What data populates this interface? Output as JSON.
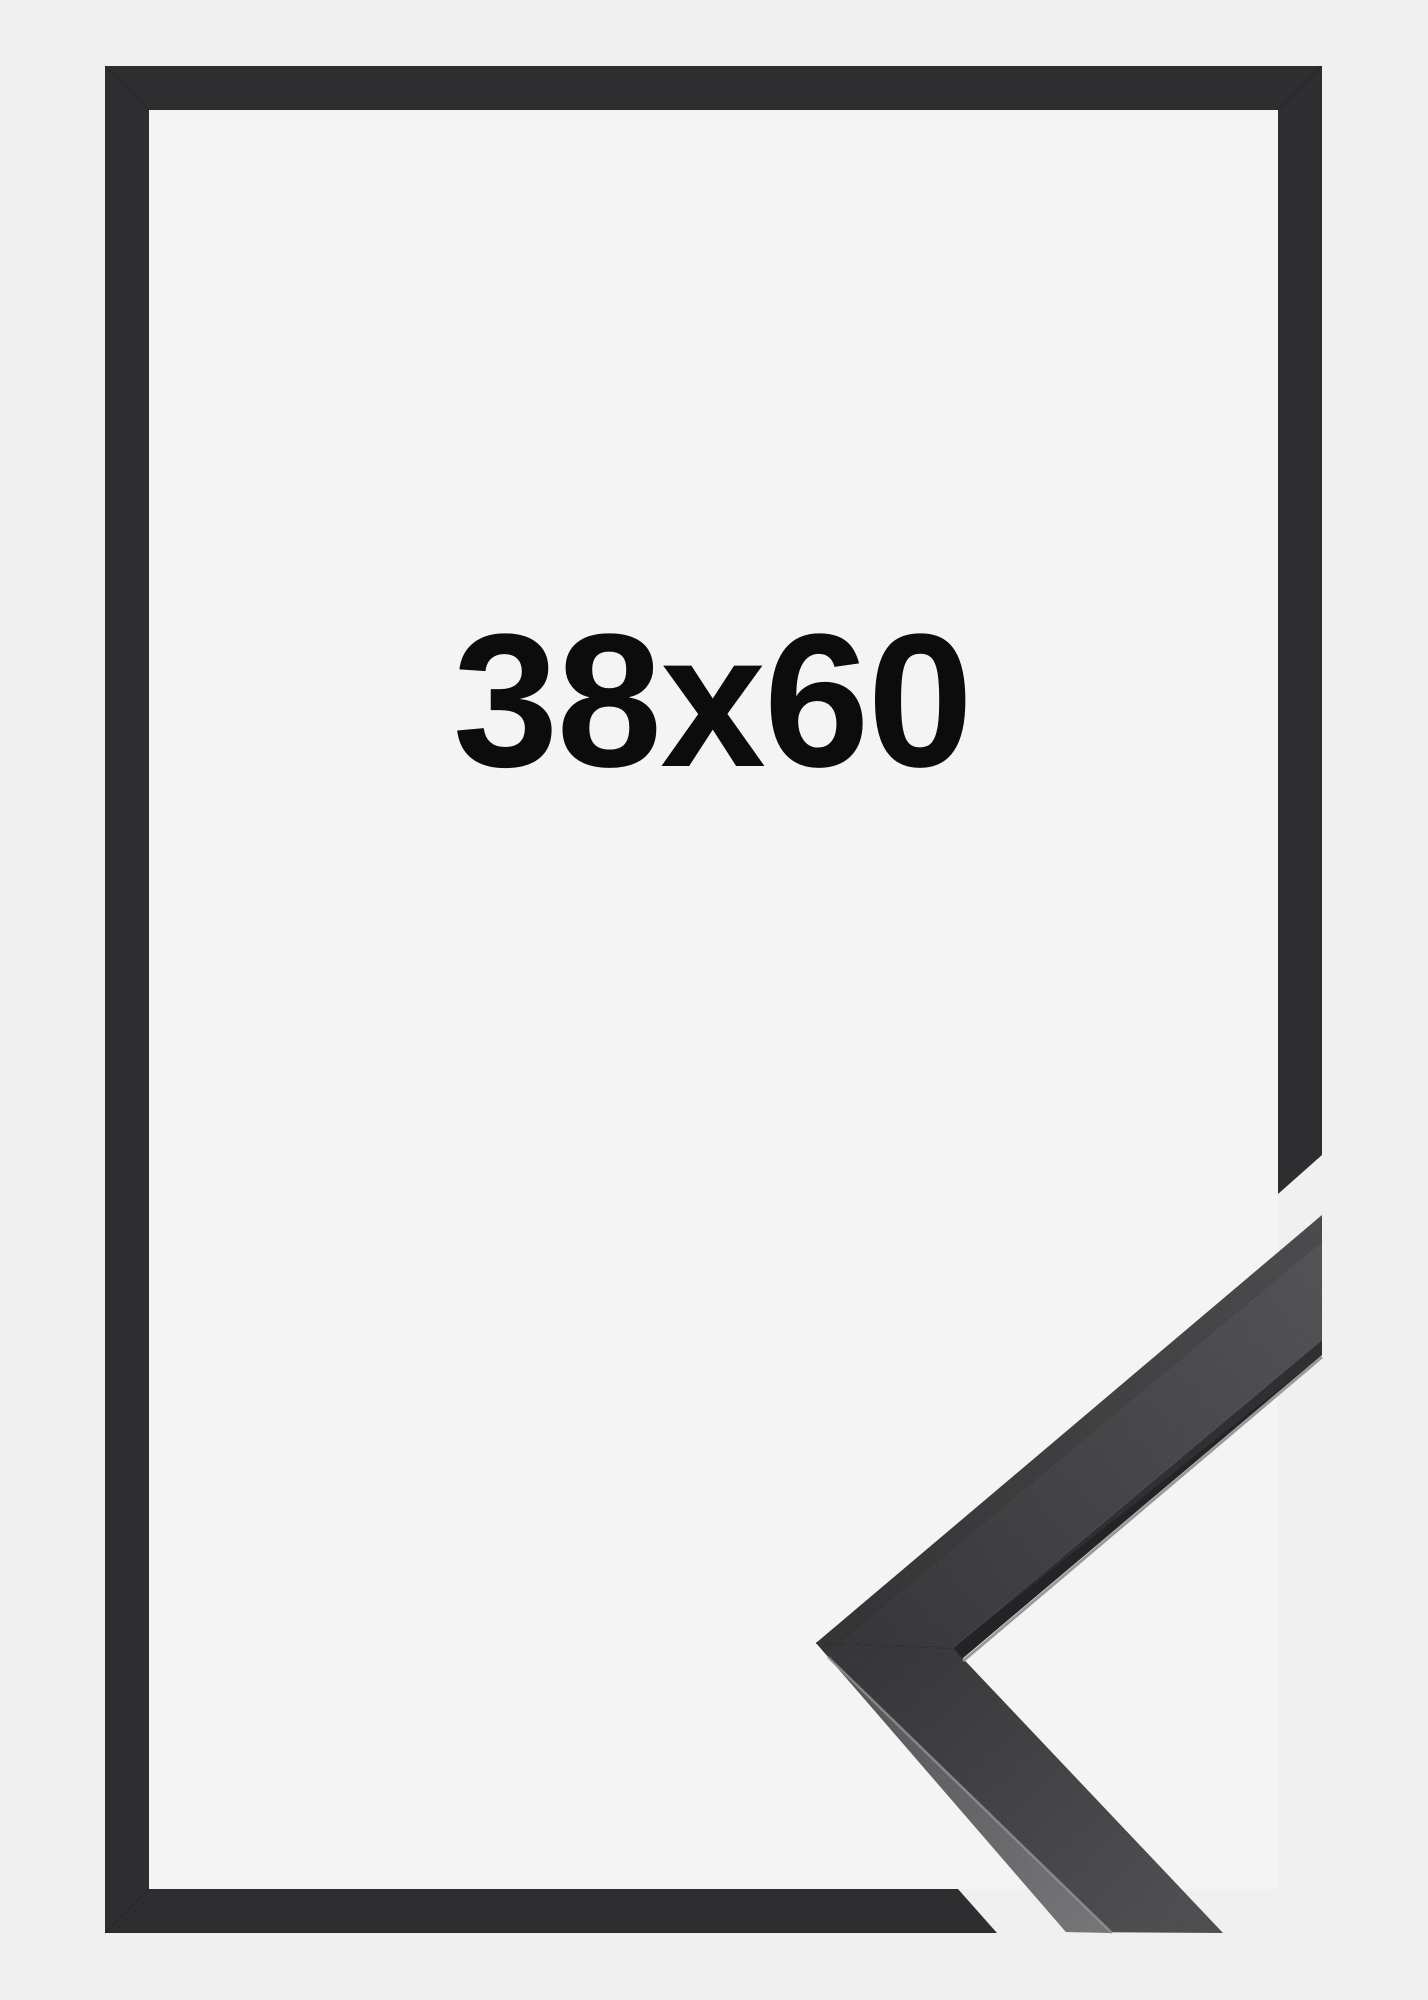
{
  "product": {
    "size_label": "38x60"
  },
  "colors": {
    "background": "#f0f0f1",
    "frame_interior": "#f4f4f5",
    "frame_bar": "#2e2e30",
    "corner_tip": "#2c2c2e",
    "corner_face_light": "#4a4a4d",
    "corner_lower_face_light": "#454548",
    "corner_top_strip_dark": "#49494c",
    "corner_top_strip_light": "#6f6f72",
    "edge_highlight": "#919193",
    "lip_shadow": "#242427",
    "seam": "#1e1e20",
    "label_text": "#0c0c0c"
  }
}
